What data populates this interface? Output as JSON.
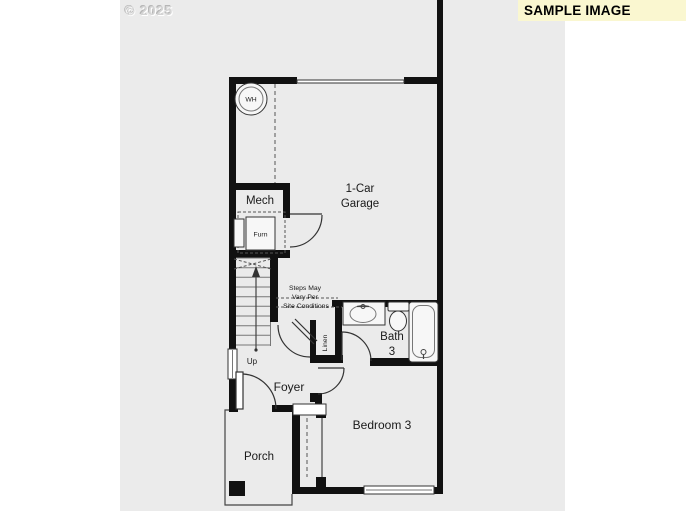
{
  "watermark": "© 2025",
  "banner": {
    "label": "SAMPLE IMAGE",
    "bg": "#FAF7D0",
    "text_color": "#000000"
  },
  "rooms": {
    "garage": {
      "line1": "1-Car",
      "line2": "Garage"
    },
    "mech": "Mech",
    "bath": {
      "line1": "Bath",
      "line2": "3"
    },
    "foyer": "Foyer",
    "bedroom": "Bedroom 3",
    "porch": "Porch"
  },
  "fixtures": {
    "water_heater": "WH",
    "furnace": "Furn",
    "linen": "Linen",
    "stairs_direction": "Up",
    "stairs_note": [
      "Steps May",
      "Vary Per",
      "Site Conditions"
    ]
  },
  "colors": {
    "wall": "#111111",
    "plan_background": "#EBEBEB",
    "banner_background": "#FAF7D0",
    "line": "#444444",
    "garage_door_line": "#9A9A9A"
  }
}
